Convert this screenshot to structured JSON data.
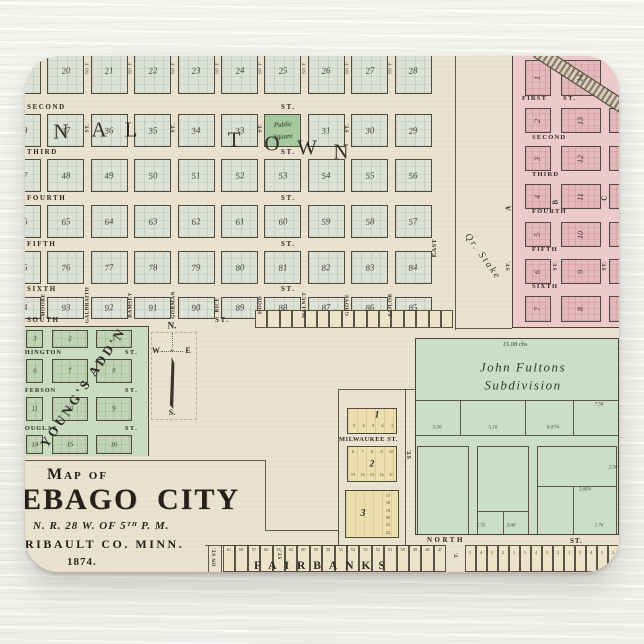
{
  "map": {
    "compass": {
      "n": "N.",
      "w": "W",
      "e": "E",
      "s": "S.",
      "cross": "+"
    },
    "original_town": {
      "overlay_left": [
        "N",
        "A",
        "L"
      ],
      "overlay_right": [
        "T",
        "O",
        "W",
        "N"
      ],
      "streets_horizontal": [
        "SECOND",
        "THIRD",
        "FOURTH",
        "FIFTH",
        "SIXTH",
        "SOUTH"
      ],
      "street_suffix": "ST.",
      "width_note": "80 F",
      "public_square": [
        "Public",
        "Square"
      ],
      "block_rows": [
        [
          "19",
          "20",
          "21",
          "22",
          "23",
          "24",
          "25",
          "26",
          "27",
          "28"
        ],
        [
          "38",
          "37",
          "36",
          "35",
          "34",
          "33",
          "",
          "31",
          "30",
          "29"
        ],
        [
          "47",
          "48",
          "49",
          "50",
          "51",
          "52",
          "53",
          "54",
          "55",
          "56"
        ],
        [
          "66",
          "65",
          "64",
          "63",
          "62",
          "61",
          "60",
          "59",
          "58",
          "57"
        ],
        [
          "75",
          "76",
          "77",
          "78",
          "79",
          "80",
          "81",
          "82",
          "83",
          "84"
        ],
        [
          "94",
          "93",
          "92",
          "91",
          "90",
          "89",
          "88",
          "87",
          "86",
          "85"
        ]
      ],
      "streets_vertical": [
        "MOORE",
        "GALBRAITH",
        "RAMSEY",
        "GORMAN",
        "RICE",
        "HOOD",
        "WALNUT",
        "GROVE",
        "SAILOR"
      ],
      "east_street": "EAST"
    },
    "road": {
      "label": "Qr. Stake"
    },
    "east_addition": {
      "streets": [
        "FIRST",
        "SECOND",
        "THIRD",
        "FOURTH",
        "FIFTH",
        "SIXTH"
      ],
      "street_suffix": "ST.",
      "col_a": [
        "1",
        "2",
        "3",
        "4",
        "5",
        "6",
        "7"
      ],
      "col_b": [
        "14",
        "13",
        "12",
        "11",
        "10",
        "9",
        "8"
      ],
      "col_c": [
        "",
        "15",
        "16",
        "17",
        "18",
        "19",
        "20"
      ],
      "cross_letters": [
        "A",
        "B",
        "C"
      ]
    },
    "youngs_addition": {
      "name": "YOUNG'S ADD'N",
      "streets_left": [
        "HINGTON",
        "FERSON",
        "OUGLAS"
      ],
      "street_suffix": "ST.",
      "block_rows": [
        [
          "3",
          "2",
          "1"
        ],
        [
          "6",
          "7",
          "8"
        ],
        [
          "11",
          "10",
          "9"
        ],
        [
          "14",
          "15",
          "16"
        ]
      ]
    },
    "title_block": {
      "line1": "Map of",
      "city_word1": "EBAGO",
      "city_word2": "CITY",
      "township": "N. R. 28 W. OF 5ᵀᴴ P. M.",
      "county": "RIBAULT CO. MINN.",
      "year": "1874."
    },
    "fultons": {
      "name_line1": "John Fultons",
      "name_line2": "Subdivision",
      "area_note": "15.08 chs",
      "measures_mid": [
        "5.50",
        "5.16",
        "6.07¾"
      ],
      "measure_right": "7.58",
      "measures_bottom": [
        "2.55",
        "5.00",
        "2.60¾",
        "2.76"
      ],
      "measure_side": "2.50"
    },
    "milwaukee": {
      "street": "MILWAUKEE ST.",
      "blocks": [
        "1",
        "2",
        "3"
      ],
      "b1_lots": [
        "5",
        "4",
        "3",
        "2",
        "1"
      ],
      "b2_lots_top": [
        "6",
        "7",
        "8",
        "9",
        "10"
      ],
      "b2_lots_bottom": [
        "15",
        "14",
        "13",
        "12",
        "11"
      ],
      "b3_lots": [
        "17",
        "18",
        "19",
        "20",
        "21",
        "22"
      ]
    },
    "north_street": {
      "name": "NORTH",
      "suffix": "ST."
    },
    "bottom_strip": {
      "name": "FAIRBANKS",
      "left_road": "ON ST.",
      "mid_mark": "ST.",
      "right_road": "T.",
      "right_lots_cycle": [
        "5",
        "4",
        "3",
        "2",
        "1"
      ],
      "left_lots_numbers": [
        "61",
        "68",
        "57",
        "66",
        "56",
        "63",
        "60",
        "59",
        "58",
        "55",
        "54",
        "53",
        "52",
        "51",
        "50",
        "49",
        "48",
        "47"
      ]
    }
  }
}
